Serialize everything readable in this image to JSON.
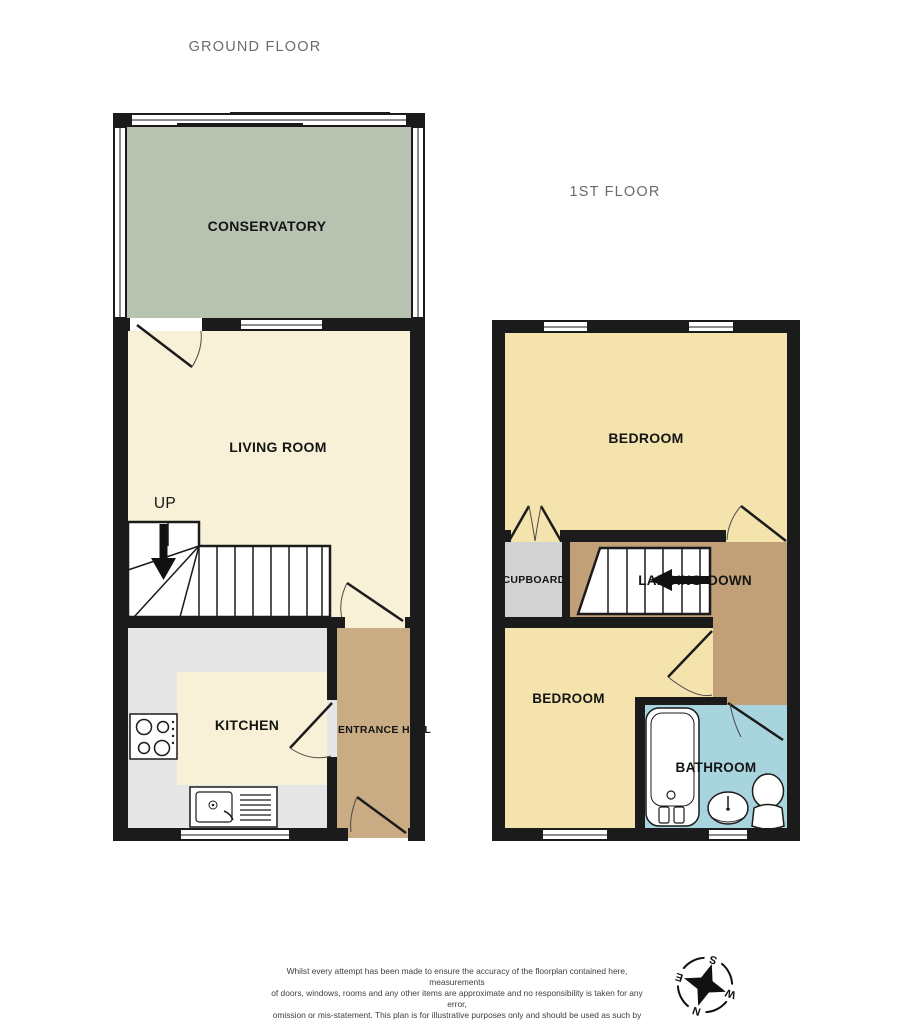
{
  "ground_floor": {
    "title": "GROUND FLOOR",
    "rooms": {
      "conservatory": "CONSERVATORY",
      "living_room": "LIVING ROOM",
      "kitchen": "KITCHEN",
      "entrance_hall": "ENTRANCE HALL"
    },
    "stair_direction": "UP"
  },
  "first_floor": {
    "title": "1ST FLOOR",
    "rooms": {
      "bedroom_rear": "BEDROOM",
      "bedroom_front": "BEDROOM",
      "bathroom": "BATHROOM",
      "cupboard": "CUPBOARD",
      "landing": "LANDING"
    },
    "stair_direction": "DOWN"
  },
  "compass": {
    "north": "N",
    "east": "E",
    "south": "S",
    "west": "W"
  },
  "footer": {
    "disclaimer_lines": [
      "Whilst every attempt has been made to ensure the accuracy of the floorplan contained here, measurements",
      "of doors, windows, rooms and any other items are approximate and no responsibility is taken for any error,",
      "omission or mis-statement. This plan is for illustrative purposes only and should be used as such by any",
      "prospective purchaser. The services, systems and appliances shown have not been tested and no guarantee",
      "as to their operability or efficiency can be given."
    ],
    "credit": "Made with Metropix ©2025"
  },
  "colors": {
    "wall": "#1b1b1b",
    "conservatory": "#b8c2b0",
    "cream": "#f9f1d7",
    "counter": "#e6e6e6",
    "entrance": "#c9ac83",
    "landing": "#c2a077",
    "bedroom": "#f5e3ad",
    "bathroom": "#a8d4dd",
    "cupboard": "#d2d2d2",
    "title_text": "#6b6b6b",
    "label_text": "#141414"
  }
}
